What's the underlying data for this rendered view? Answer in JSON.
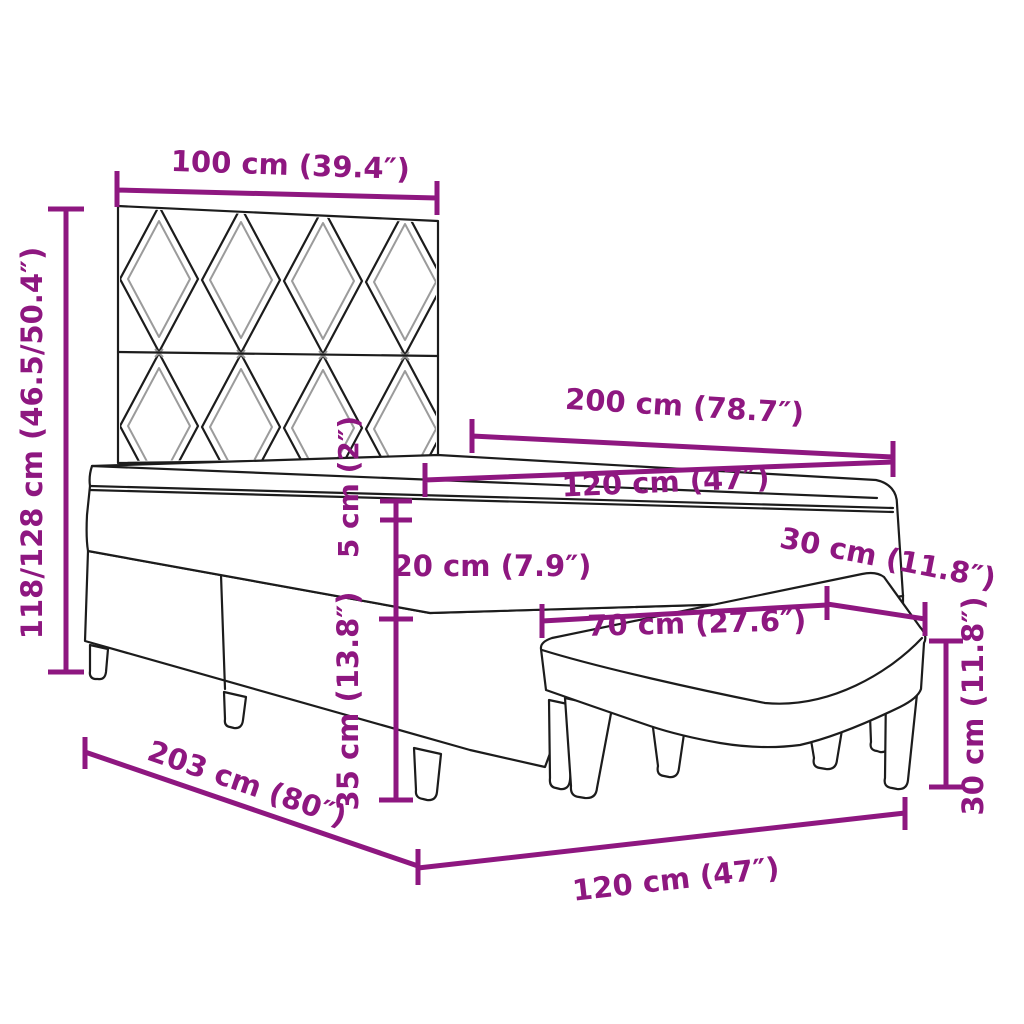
{
  "meta": {
    "background": "#ffffff",
    "accent_color": "#8E1780",
    "line_color": "#1c1c1c",
    "subject": "box spring bed with headboard, mattress topper and bench - dimension diagram"
  },
  "dimensions": {
    "headboard_width": "100 cm (39.4″)",
    "total_height": "118/128 cm (46.5/50.4″)",
    "bed_length": "200 cm (78.7″)",
    "mattress_width": "120 cm (47″)",
    "topper_thickness": "5 cm (2″)",
    "mattress_thickness": "20 cm (7.9″)",
    "base_height": "35 cm (13.8″)",
    "bench_depth": "30 cm (11.8″)",
    "bench_length": "70 cm (27.6″)",
    "bench_height": "30 cm (11.8″)",
    "frame_length": "203 cm (80″)",
    "frame_width": "120 cm (47″)"
  }
}
